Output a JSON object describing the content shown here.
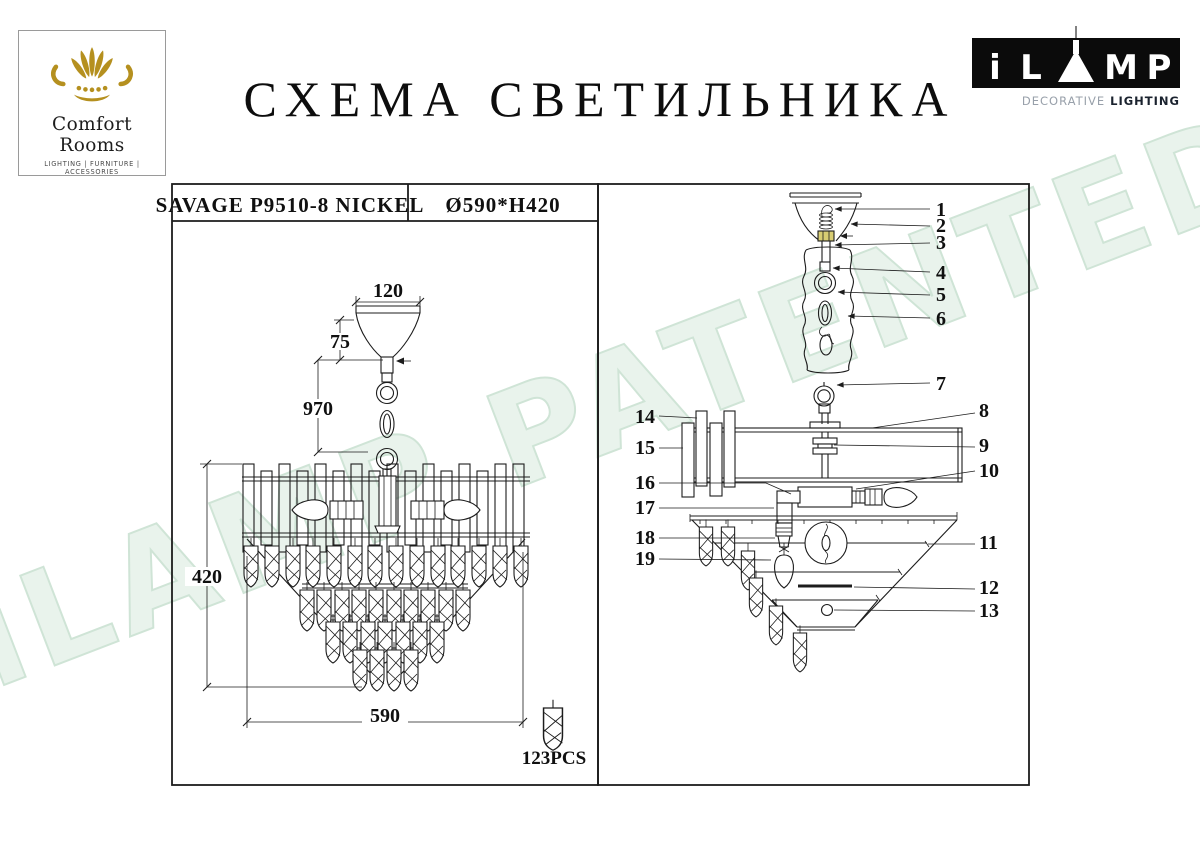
{
  "watermark": {
    "text": "iLAMP PATENTED"
  },
  "brand": {
    "name": "Comfort Rooms",
    "tagline": "LIGHTING | FURNITURE | ACCESSORIES"
  },
  "title": "СХЕМА СВЕТИЛЬНИКА",
  "ilamp": {
    "letters": {
      "i": "i",
      "l": "L",
      "m": "M",
      "p": "P"
    },
    "subtitle_light": "DECORATIVE",
    "subtitle_bold": "LIGHTING"
  },
  "left_panel": {
    "model": "SAVAGE P9510-8 NICKEL",
    "size": "Ø590*H420",
    "dim_top_width": "120",
    "dim_canopy": "75",
    "dim_chain": "970",
    "dim_height": "420",
    "dim_diameter": "590",
    "crystal_count": "123PCS"
  },
  "right_panel": {
    "parts": [
      "1",
      "2",
      "3",
      "4",
      "5",
      "6",
      "7",
      "8",
      "9",
      "10",
      "11",
      "12",
      "13",
      "14",
      "15",
      "16",
      "17",
      "18",
      "19"
    ]
  },
  "colors": {
    "accent_gold": "#b5901f",
    "connector_yellow": "#d8cd72",
    "watermark_green": "#e9f3ec",
    "line_color": "#1c1c1c"
  }
}
